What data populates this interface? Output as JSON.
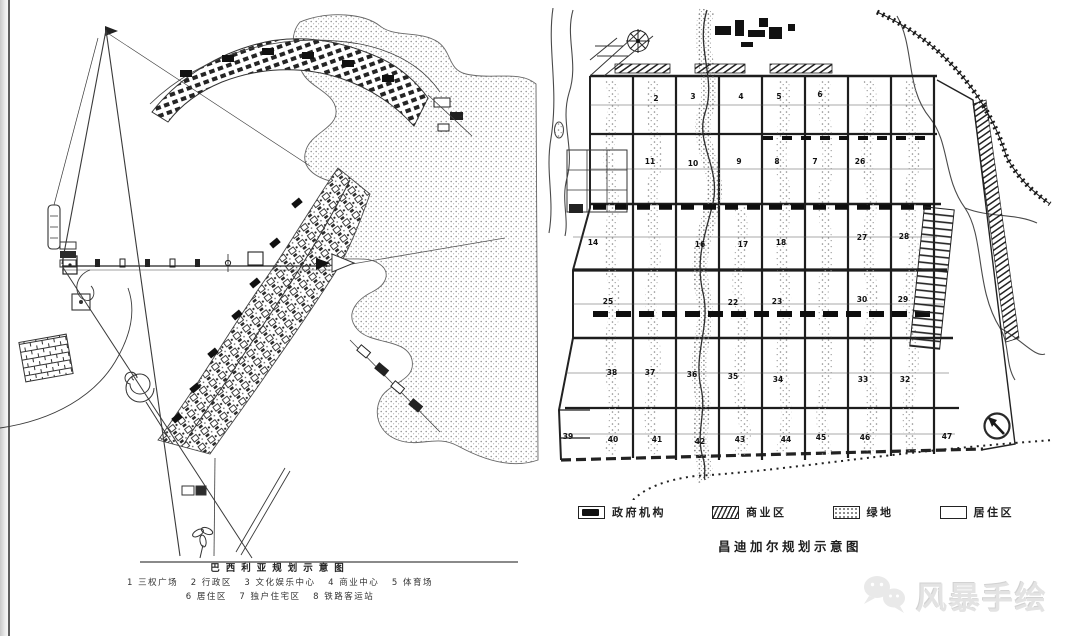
{
  "canvas": {
    "background": "#ffffff",
    "ink": "#1a1a1a",
    "stipple": "#8a8a8a",
    "watermark_color": "#e3e3e3"
  },
  "left_map": {
    "name": "Brasilia plan sketch",
    "title": "巴西利亚规划示意图",
    "legend_line1": "1 三权广场   2 行政区   3 文化娱乐中心   4 商业中心   5 体育场",
    "legend_line2": "6 居住区   7 独户住宅区   8 铁路客运站"
  },
  "right_map": {
    "name": "Chandigarh plan sketch",
    "title": "昌迪加尔规划示意图",
    "legend": [
      {
        "symbol": "government-block",
        "label": "政府机构"
      },
      {
        "symbol": "hatched-block",
        "label": "商业区"
      },
      {
        "symbol": "stippled-block",
        "label": "绿地"
      },
      {
        "symbol": "empty-block",
        "label": "居住区"
      }
    ],
    "sector_numbers": [
      "2",
      "3",
      "4",
      "5",
      "6",
      "11",
      "10",
      "9",
      "8",
      "7",
      "26",
      "14",
      "16",
      "17",
      "18",
      "27",
      "28",
      "25",
      "22",
      "23",
      "30",
      "29",
      "38",
      "37",
      "36",
      "35",
      "34",
      "33",
      "32",
      "39",
      "40",
      "41",
      "42",
      "43",
      "44",
      "45",
      "46",
      "47"
    ]
  },
  "watermark": {
    "label": "风暴手绘",
    "icon": "wechat-bubbles"
  }
}
